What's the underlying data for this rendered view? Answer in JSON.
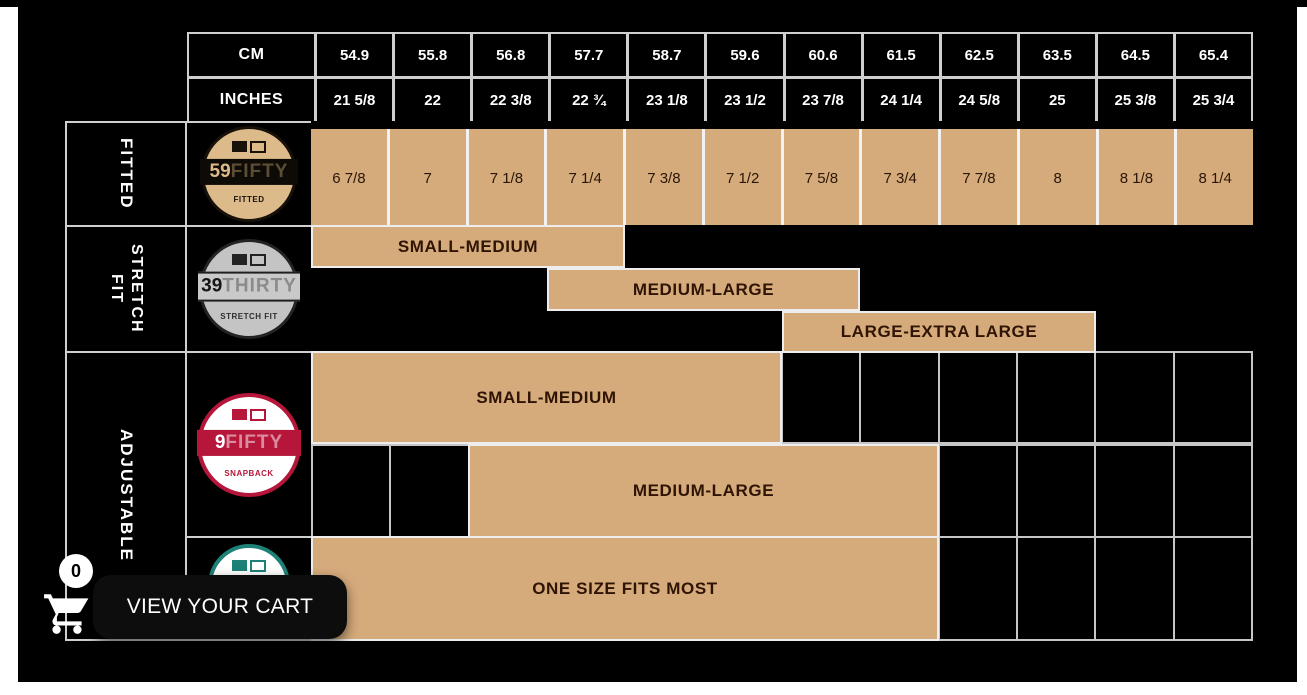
{
  "colors": {
    "canvas": "#000000",
    "tan_fill": "#d6ab7c",
    "grid_line": "#cfcfcf",
    "empty_cell_line": "#c6c6c6",
    "bar_border": "#ededed",
    "tan_text": "#2f1404",
    "header_text": "#ffffff",
    "logo_59fifty_tan": "#dcba8a",
    "logo_39thirty_silver": "#c4c4c4",
    "logo_9fifty_red": "#b5163a",
    "logo_teal": "#1d8177",
    "button_bg": "#0d0d0d",
    "button_text": "#ffffff"
  },
  "table": {
    "header": {
      "cm_label": "CM",
      "inches_label": "INCHES",
      "cm_values": [
        "54.9",
        "55.8",
        "56.8",
        "57.7",
        "58.7",
        "59.6",
        "60.6",
        "61.5",
        "62.5",
        "63.5",
        "64.5",
        "65.4"
      ],
      "inches_values": [
        "21 5/8",
        "22",
        "22 3/8",
        "22 ¾",
        "23 1/8",
        "23 1/2",
        "23 7/8",
        "24 1/4",
        "24 5/8",
        "25",
        "25 3/8",
        "25 3/4"
      ]
    },
    "sections": [
      {
        "id": "fitted",
        "label": "FITTED",
        "logo": {
          "id": "59fifty-logo",
          "prefix": "59",
          "name": "FIFTY",
          "sub": "FITTED"
        },
        "sizes": [
          "6 7/8",
          "7",
          "7 1/8",
          "7 1/4",
          "7 3/8",
          "7 1/2",
          "7 5/8",
          "7 3/4",
          "7 7/8",
          "8",
          "8 1/8",
          "8 1/4"
        ]
      },
      {
        "id": "stretch-fit",
        "label": "STRETCH FIT",
        "logo": {
          "id": "39thirty-logo",
          "prefix": "39",
          "name": "THIRTY",
          "sub": "STRETCH FIT"
        },
        "grid_cells": false,
        "bars": [
          {
            "label": "SMALL-MEDIUM",
            "start_col": 1,
            "span": 4
          },
          {
            "label": "MEDIUM-LARGE",
            "start_col": 4,
            "span": 4
          },
          {
            "label": "LARGE-EXTRA LARGE",
            "start_col": 7,
            "span": 4
          }
        ]
      },
      {
        "id": "adjustable-snapback",
        "label": "ADJUSTABLE",
        "logo": {
          "id": "9fifty-logo",
          "prefix": "9",
          "name": "FIFTY",
          "sub": "SNAPBACK"
        },
        "grid_cells": true,
        "bars": [
          {
            "label": "SMALL-MEDIUM",
            "start_col": 1,
            "span": 6
          },
          {
            "label": "MEDIUM-LARGE",
            "start_col": 3,
            "span": 6
          }
        ]
      },
      {
        "id": "one-size",
        "label": "",
        "logo": {
          "id": "teal-logo",
          "prefix": "",
          "name": "",
          "sub": ""
        },
        "grid_cells": true,
        "bars": [
          {
            "label": "ONE SIZE FITS MOST",
            "start_col": 1,
            "span": 8
          }
        ]
      }
    ]
  },
  "cart": {
    "badge_count": "0",
    "button_label": "VIEW YOUR CART"
  }
}
